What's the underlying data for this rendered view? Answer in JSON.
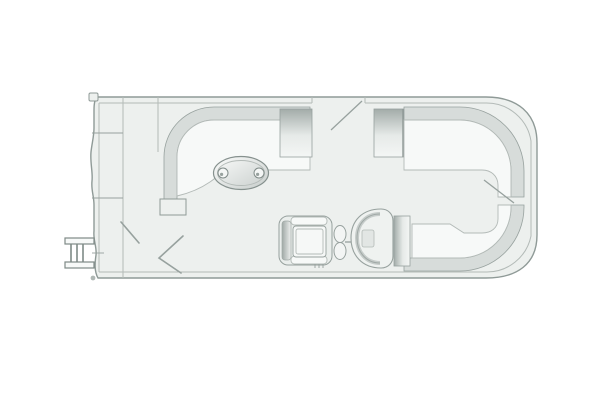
{
  "diagram": {
    "type": "boat-floorplan",
    "subject": "Pontoon boat deck layout, top-down schematic line drawing",
    "orientation": {
      "bow": "right",
      "stern": "left"
    },
    "components": [
      "hull outline with rounded bow corners",
      "stern boarding ladder",
      "stern corner fitting",
      "perimeter fence rail",
      "aft port wraparound L-lounge with seat-back block",
      "oval cocktail table with two cup holders",
      "entry gate with swing line",
      "bow port L-lounge wrapping top-right corner",
      "bow starboard L-lounge wrapping bottom-right corner",
      "helm captain chair",
      "steering wheel",
      "helm console with windscreen rim",
      "deck chevron gate markings",
      "small dimension tick marks"
    ]
  },
  "colors": {
    "bg": "#ffffff",
    "deck": "#edf0ee",
    "hull": "#8f9a97",
    "soft": "#b3bab7",
    "mid": "#97a19e",
    "strong": "#7f8a87",
    "band": "#d7dcda",
    "cushion": "#f7f9f8",
    "shade": "#a3aca9",
    "tableshade": "#c7cdcb"
  }
}
